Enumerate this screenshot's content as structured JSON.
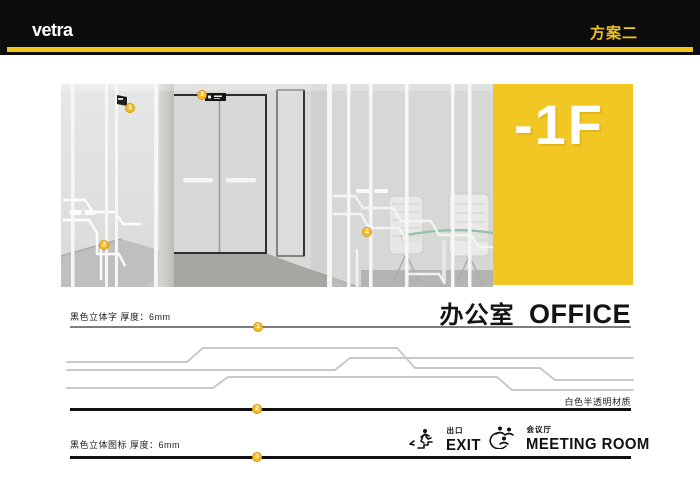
{
  "header": {
    "logo": "vetra",
    "plan": "方案二"
  },
  "hero": {
    "floor": "-1F"
  },
  "title": {
    "zh": "办公室",
    "en": "OFFICE"
  },
  "specs": {
    "letters": "黑色立体字 厚度：6mm",
    "material": "白色半透明材质",
    "icons": "黑色立体图标 厚度：6mm"
  },
  "photo_markers": [
    {
      "n": "1"
    },
    {
      "n": "2"
    },
    {
      "n": "3"
    },
    {
      "n": "2"
    }
  ],
  "line_markers": [
    {
      "n": "1"
    },
    {
      "n": "2"
    },
    {
      "n": "3"
    }
  ],
  "signs": {
    "exit_zh": "出口",
    "exit_en": "EXIT",
    "meeting_zh": "会议厅",
    "meeting_en": "MEETING ROOM"
  },
  "colors": {
    "accent_yellow": "#f2c51d",
    "floor_block_yellow": "#f2c623",
    "marker_yellow": "#f5be2e",
    "header_black": "#0d0d0d",
    "deco_line_gray": "#c8c9c7"
  }
}
